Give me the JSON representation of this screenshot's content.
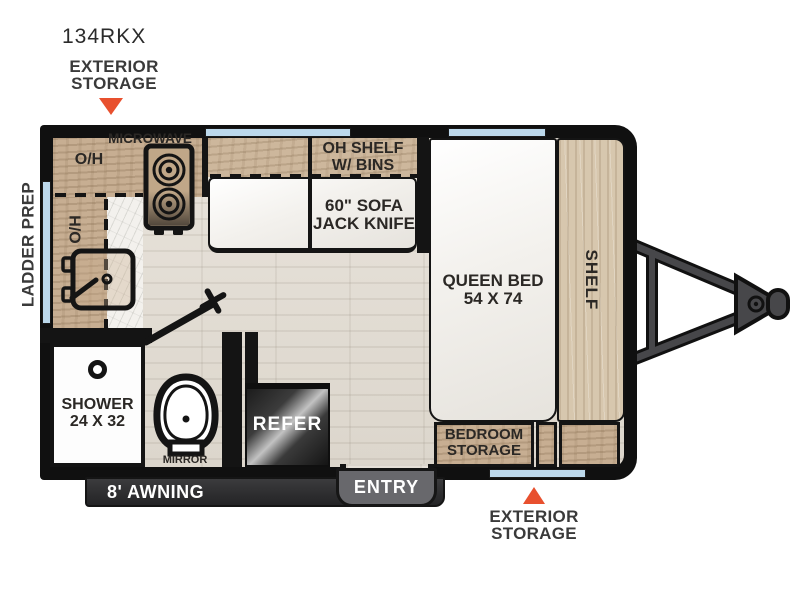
{
  "model": "134RKX",
  "callouts": {
    "exterior_storage_top": {
      "line1": "EXTERIOR",
      "line2": "STORAGE"
    },
    "exterior_storage_bottom": {
      "line1": "EXTERIOR",
      "line2": "STORAGE"
    },
    "ladder_prep": "LADDER PREP"
  },
  "kitchen": {
    "microwave": "MICROWAVE",
    "overhead_top": "O/H",
    "overhead_side": "O/H"
  },
  "living": {
    "oh_shelf": {
      "line1": "OH SHELF",
      "line2": "W/ BINS"
    },
    "sofa": {
      "line1": "60\" SOFA",
      "line2": "JACK KNIFE"
    }
  },
  "bedroom": {
    "queen_bed": {
      "line1": "QUEEN BED",
      "line2": "54 X 74"
    },
    "shelf": "SHELF",
    "storage": {
      "line1": "BEDROOM",
      "line2": "STORAGE"
    }
  },
  "bathroom": {
    "shower": {
      "line1": "SHOWER",
      "line2": "24 X 32"
    },
    "mirror": "MIRROR"
  },
  "appliances": {
    "refrigerator": "REFER"
  },
  "exterior_features": {
    "awning": "8' AWNING",
    "entry": "ENTRY"
  },
  "colors": {
    "accent_red": "#E8502E",
    "window_blue": "#BCD8EB",
    "wall_black": "#141414",
    "wood_tan": "#C7AE92",
    "wood_light": "#D7C7AE",
    "floor": "#E3DED5",
    "awning_bar": "#2F2F31",
    "entry_tab": "#68686C"
  }
}
